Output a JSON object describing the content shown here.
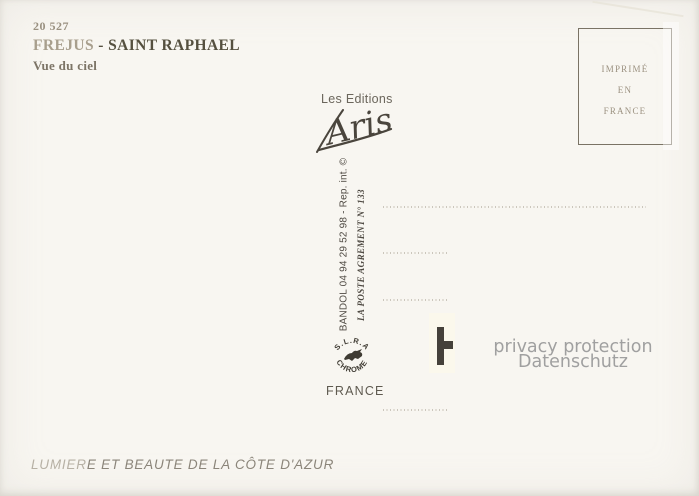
{
  "card": {
    "ref_number": "20 527",
    "title_part1": "FREJUS",
    "title_part2": " - SAINT RAPHAEL",
    "subtitle": "Vue du ciel"
  },
  "publisher": {
    "label": "Les Editions",
    "signature": "Aris"
  },
  "postal": {
    "phone_line": "BANDOL 04 94 29 52 98 - Rep. int. ©",
    "agrement_line": "LA POSTE AGREMENT N° 133"
  },
  "maker_logo": {
    "arc_top": "S.L.R.A",
    "arc_bottom": "CHROME",
    "country": "FRANCE"
  },
  "stamp_box": {
    "lines": [
      "IMPRIMÉ",
      "EN",
      "FRANCE"
    ]
  },
  "privacy_watermark": {
    "line1": "privacy protection",
    "line2": "Datenschutz"
  },
  "footer": {
    "slogan_faded": "LUMIER",
    "slogan_main": "E ET BEAUTE DE LA CÔTE D'AZUR"
  },
  "colors": {
    "background": "#f8f6f1",
    "title_dark": "#55503f",
    "title_faded": "#a89f8d",
    "ink_gray": "#4f4a43",
    "stamp_text": "#9b9180",
    "dotted_line": "#c3beb2",
    "watermark_gray": "#a0a0a0",
    "redaction_mark": "#45413a"
  }
}
